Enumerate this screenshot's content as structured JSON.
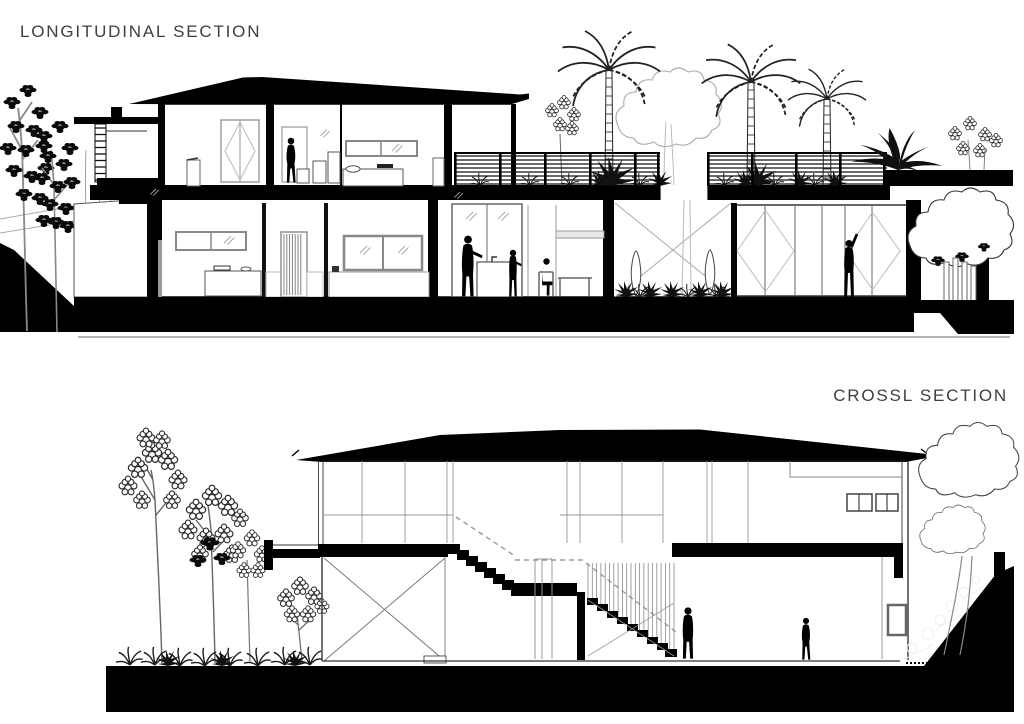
{
  "page": {
    "background": "#ffffff",
    "drawing_ink": "#000000",
    "title_color": "#3f3f3f"
  },
  "sections": {
    "longitudinal": {
      "title": "LONGITUDINAL SECTION"
    },
    "cross": {
      "title": "CROSSL SECTION"
    }
  }
}
